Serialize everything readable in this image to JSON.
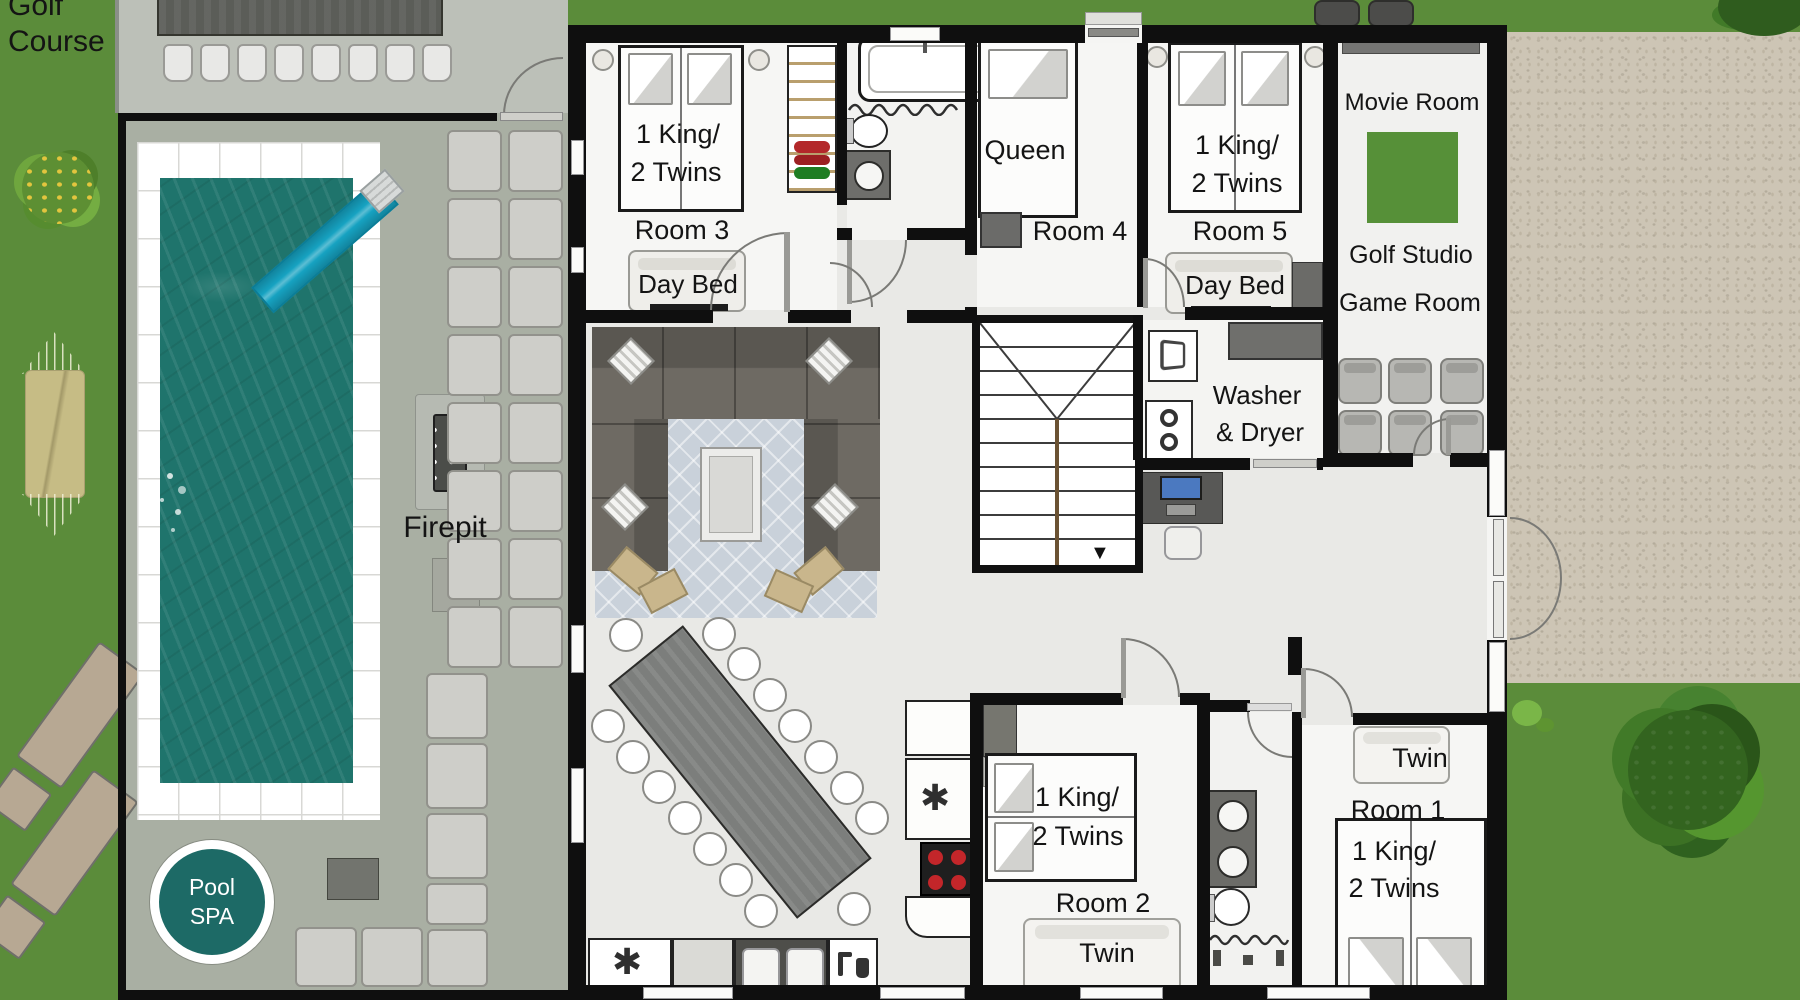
{
  "labels": {
    "golf_1": "Golf",
    "golf_2": "Course",
    "firepit": "Firepit",
    "pool_1": "Pool",
    "pool_2": "SPA"
  },
  "rooms": {
    "room3": {
      "name": "Room 3",
      "bed_1": "1 King/",
      "bed_2": "2 Twins",
      "daybed": "Day Bed"
    },
    "room4": {
      "name": "Room 4",
      "bed": "Queen"
    },
    "room5": {
      "name": "Room 5",
      "bed_1": "1 King/",
      "bed_2": "2 Twins",
      "daybed": "Day Bed"
    },
    "media": {
      "name": "Movie Room",
      "golf": "Golf Studio",
      "game": "Game Room"
    },
    "laundry": {
      "line_1": "Washer",
      "line_2": "& Dryer"
    },
    "room2": {
      "name": "Room 2",
      "bed_1": "1 King/",
      "bed_2": "2 Twins",
      "twin": "Twin"
    },
    "room1": {
      "name": "Room 1",
      "twin": "Twin",
      "bed_1": "1 King/",
      "bed_2": "2 Twins"
    }
  },
  "icons": {
    "appliance_star": "✱",
    "stairs_down_arrow": "▼"
  },
  "colors": {
    "grass": "#5b8c3a",
    "deck": "#a9afa3",
    "patio": "#bcc0b8",
    "gravel": "#cdc5b5",
    "pool_water": "#1f746c",
    "spa_badge": "#1d6a66",
    "slide": "#16a2c1",
    "screen_green": "#569038",
    "wall": "#0f0f0f"
  }
}
